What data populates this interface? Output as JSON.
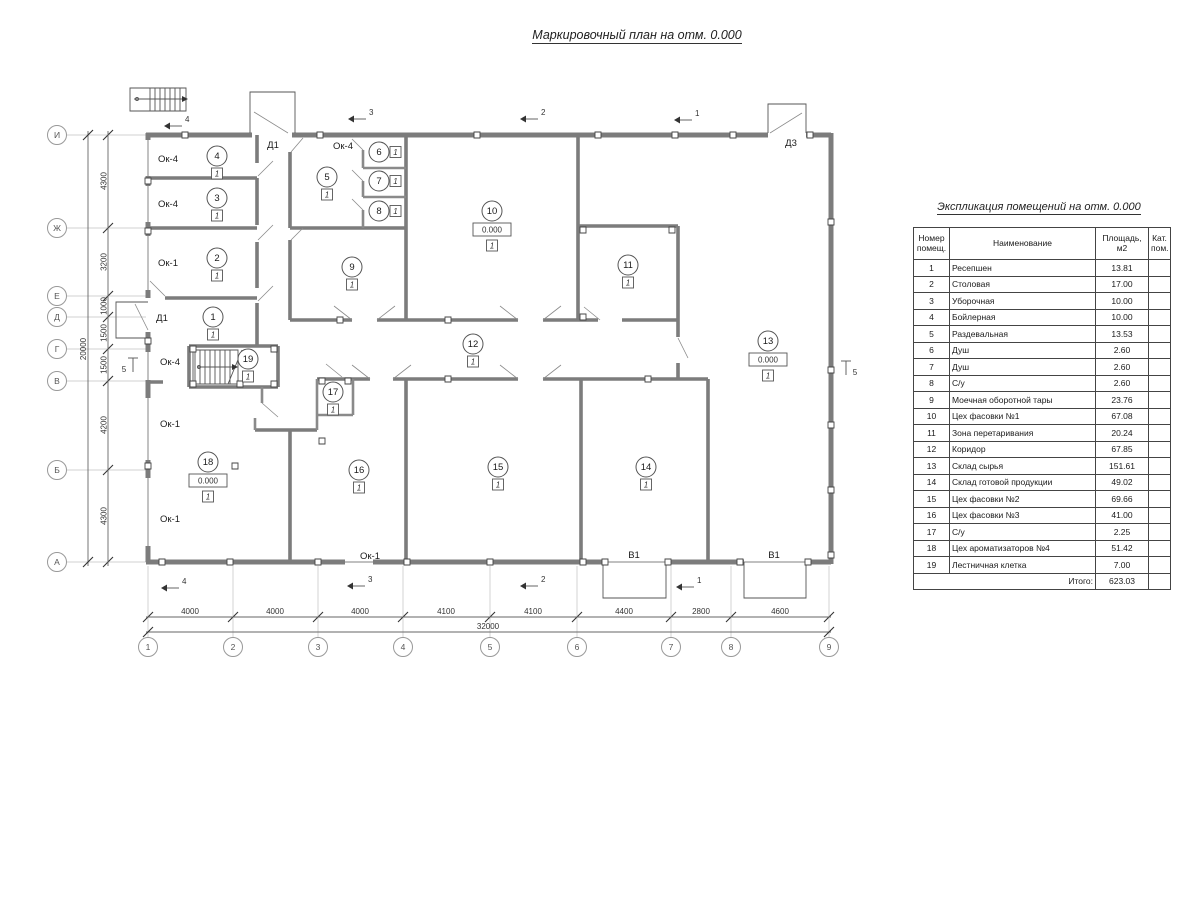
{
  "title": "Маркировочный план на отм. 0.000",
  "plan": {
    "floor_mark": "1",
    "rooms": [
      {
        "num": "1",
        "x": 213,
        "y": 317
      },
      {
        "num": "2",
        "x": 217,
        "y": 258
      },
      {
        "num": "3",
        "x": 217,
        "y": 198
      },
      {
        "num": "4",
        "x": 217,
        "y": 156
      },
      {
        "num": "5",
        "x": 327,
        "y": 177
      },
      {
        "num": "6",
        "x": 379,
        "y": 152,
        "side": true
      },
      {
        "num": "7",
        "x": 379,
        "y": 181,
        "side": true
      },
      {
        "num": "8",
        "x": 379,
        "y": 211,
        "side": true
      },
      {
        "num": "9",
        "x": 352,
        "y": 267
      },
      {
        "num": "10",
        "x": 492,
        "y": 211,
        "elev": "0.000"
      },
      {
        "num": "11",
        "x": 628,
        "y": 265
      },
      {
        "num": "12",
        "x": 473,
        "y": 344
      },
      {
        "num": "13",
        "x": 768,
        "y": 341,
        "elev": "0.000"
      },
      {
        "num": "14",
        "x": 646,
        "y": 467
      },
      {
        "num": "15",
        "x": 498,
        "y": 467
      },
      {
        "num": "16",
        "x": 359,
        "y": 470
      },
      {
        "num": "17",
        "x": 333,
        "y": 392
      },
      {
        "num": "18",
        "x": 208,
        "y": 462,
        "elev": "0.000"
      },
      {
        "num": "19",
        "x": 248,
        "y": 359
      }
    ],
    "window_labels": [
      {
        "text": "Ок-4",
        "x": 168,
        "y": 162
      },
      {
        "text": "Ок-4",
        "x": 168,
        "y": 207
      },
      {
        "text": "Ок-1",
        "x": 168,
        "y": 266
      },
      {
        "text": "Ок-4",
        "x": 170,
        "y": 365
      },
      {
        "text": "Ок-1",
        "x": 170,
        "y": 427
      },
      {
        "text": "Ок-1",
        "x": 170,
        "y": 522
      },
      {
        "text": "Ок-4",
        "x": 343,
        "y": 149
      },
      {
        "text": "Ок-1",
        "x": 370,
        "y": 559
      }
    ],
    "door_labels": [
      {
        "text": "Д1",
        "x": 273,
        "y": 148
      },
      {
        "text": "Д1",
        "x": 162,
        "y": 321
      },
      {
        "text": "Д3",
        "x": 791,
        "y": 146
      },
      {
        "text": "В1",
        "x": 634,
        "y": 558
      },
      {
        "text": "В1",
        "x": 774,
        "y": 558
      }
    ],
    "axis_rows": [
      {
        "label": "И",
        "y": 135
      },
      {
        "label": "Ж",
        "y": 228
      },
      {
        "label": "Е",
        "y": 296
      },
      {
        "label": "Д",
        "y": 317
      },
      {
        "label": "Г",
        "y": 349
      },
      {
        "label": "В",
        "y": 381
      },
      {
        "label": "Б",
        "y": 470
      },
      {
        "label": "А",
        "y": 562
      }
    ],
    "axis_cols": [
      {
        "label": "1",
        "x": 148
      },
      {
        "label": "2",
        "x": 233
      },
      {
        "label": "3",
        "x": 318
      },
      {
        "label": "4",
        "x": 403
      },
      {
        "label": "5",
        "x": 490
      },
      {
        "label": "6",
        "x": 577
      },
      {
        "label": "7",
        "x": 671
      },
      {
        "label": "8",
        "x": 731
      },
      {
        "label": "9",
        "x": 829
      }
    ],
    "dims_left": [
      {
        "text": "4300",
        "y": 181
      },
      {
        "text": "3200",
        "y": 262
      },
      {
        "text": "1000",
        "y": 306
      },
      {
        "text": "1500",
        "y": 333
      },
      {
        "text": "1500",
        "y": 365
      },
      {
        "text": "4200",
        "y": 425
      },
      {
        "text": "4300",
        "y": 516
      }
    ],
    "total_left": "20000",
    "dims_bottom": [
      {
        "text": "4000",
        "x": 190
      },
      {
        "text": "4000",
        "x": 275
      },
      {
        "text": "4000",
        "x": 360
      },
      {
        "text": "4100",
        "x": 446
      },
      {
        "text": "4100",
        "x": 533
      },
      {
        "text": "4400",
        "x": 624
      },
      {
        "text": "2800",
        "x": 701
      },
      {
        "text": "4600",
        "x": 780
      }
    ],
    "total_bottom": "32000",
    "section_marks": [
      {
        "label": "4",
        "x": 183,
        "y": 120,
        "o": "h"
      },
      {
        "label": "3",
        "x": 367,
        "y": 113,
        "o": "h"
      },
      {
        "label": "2",
        "x": 539,
        "y": 113,
        "o": "h"
      },
      {
        "label": "1",
        "x": 693,
        "y": 114,
        "o": "h"
      },
      {
        "label": "4",
        "x": 180,
        "y": 582,
        "o": "h"
      },
      {
        "label": "3",
        "x": 366,
        "y": 580,
        "o": "h"
      },
      {
        "label": "2",
        "x": 539,
        "y": 580,
        "o": "h"
      },
      {
        "label": "1",
        "x": 695,
        "y": 581,
        "o": "h"
      },
      {
        "label": "5",
        "x": 124,
        "y": 369,
        "o": "v"
      },
      {
        "label": "5",
        "x": 855,
        "y": 372,
        "o": "v"
      }
    ]
  },
  "table": {
    "title": "Экспликация помещений на отм. 0.000",
    "headers": [
      "Номер помещ.",
      "Наименование",
      "Площадь, м2",
      "Кат. пом."
    ],
    "rows": [
      [
        "1",
        "Ресепшен",
        "13.81",
        ""
      ],
      [
        "2",
        "Столовая",
        "17.00",
        ""
      ],
      [
        "3",
        "Уборочная",
        "10.00",
        ""
      ],
      [
        "4",
        "Бойлерная",
        "10.00",
        ""
      ],
      [
        "5",
        "Раздевальная",
        "13.53",
        ""
      ],
      [
        "6",
        "Душ",
        "2.60",
        ""
      ],
      [
        "7",
        "Душ",
        "2.60",
        ""
      ],
      [
        "8",
        "С/у",
        "2.60",
        ""
      ],
      [
        "9",
        "Моечная оборотной тары",
        "23.76",
        ""
      ],
      [
        "10",
        "Цех фасовки №1",
        "67.08",
        ""
      ],
      [
        "11",
        "Зона перетаривания",
        "20.24",
        ""
      ],
      [
        "12",
        "Коридор",
        "67.85",
        ""
      ],
      [
        "13",
        "Склад сырья",
        "151.61",
        ""
      ],
      [
        "14",
        "Склад готовой продукции",
        "49.02",
        ""
      ],
      [
        "15",
        "Цех фасовки №2",
        "69.66",
        ""
      ],
      [
        "16",
        "Цех фасовки №3",
        "41.00",
        ""
      ],
      [
        "17",
        "С/у",
        "2.25",
        ""
      ],
      [
        "18",
        "Цех ароматизаторов №4",
        "51.42",
        ""
      ],
      [
        "19",
        "Лестничная клетка",
        "7.00",
        ""
      ]
    ],
    "total_label": "Итого:",
    "total_value": "623.03"
  }
}
